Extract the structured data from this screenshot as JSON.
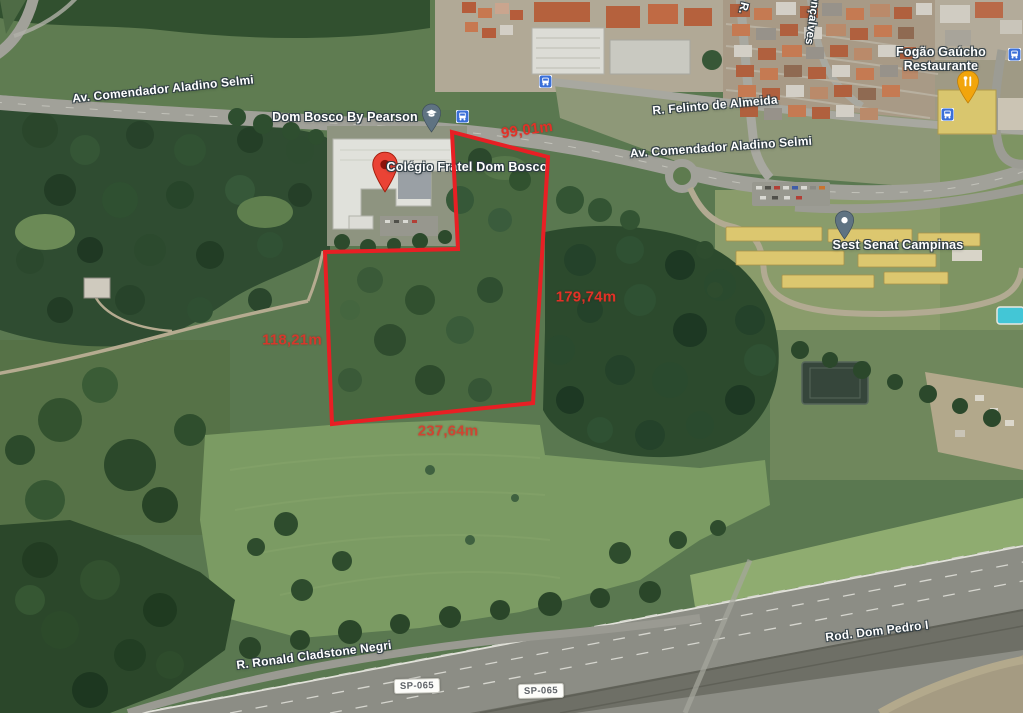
{
  "map": {
    "view": "satellite",
    "roads": {
      "av_comendador_left": "Av. Comendador Aladino Selmi",
      "av_comendador_right": "Av. Comendador Aladino Selmi",
      "felinto": "R. Felinto de Almeida",
      "goncalves_prefix": "R.",
      "goncalves": "onçalves",
      "ronald_cladstone": "R. Ronald Cladstone Negri",
      "dom_pedro": "Rod. Dom Pedro I",
      "sp065": "SP-065"
    },
    "places": {
      "dom_bosco_pearson": "Dom Bosco By Pearson",
      "colegio_dom_bosco": "Colégio Fratel Dom Bosco",
      "sest_senat": "Sest Senat Campinas",
      "fogao_gaucho_line1": "Fogão Gaúcho",
      "fogao_gaucho_line2": "Restaurante"
    }
  },
  "parcel": {
    "outline_color": "#e81f24",
    "polygon_points": "452,132 548,157 533,403 332,424 325,252 458,249",
    "measurements": {
      "top": "99,01m",
      "right": "179,74m",
      "left": "118,21m",
      "bottom": "237,64m"
    }
  },
  "icons": {
    "red_location_pin": "red teardrop marker",
    "school_pin": "slate teardrop marker with graduation cap",
    "place_pin": "slate teardrop marker with dot",
    "restaurant_pin": "yellow teardrop marker with cutlery",
    "bus_stop_icon": "blue square with white bus"
  },
  "colors": {
    "red_pin": "#ea4335",
    "slate_pin": "#5f7382",
    "restaurant_pin_yellow": "#f2a50c",
    "bus_icon_blue": "#3a6fd8",
    "badge_bg": "#ffffff",
    "badge_text": "#5f6368"
  }
}
